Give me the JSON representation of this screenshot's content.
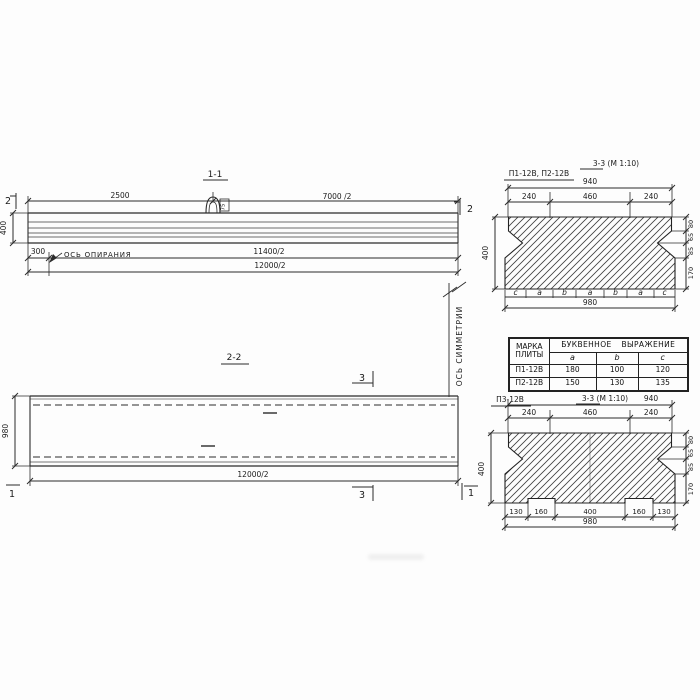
{
  "elevation": {
    "title": "1-1",
    "dim_2500": "2500",
    "dim_7000_2": "7000 /2",
    "dim_400": "400",
    "dim_300": "300",
    "support_axis": "ОСЬ ОПИРАНИЯ",
    "dim_11400_2": "11400/2",
    "dim_12000_2": "12000/2",
    "cut_mark_2": "2",
    "loop_mark": "75"
  },
  "symmetry_axis": "ОСЬ СИММЕТРИИ",
  "plan": {
    "title": "2-2",
    "dim_980": "980",
    "dim_12000_2": "12000/2",
    "cut_mark_3": "3",
    "cut_mark_1": "1"
  },
  "section_top": {
    "marks": "П1-12В, П2-12В",
    "title": "3-3 (М 1:10)",
    "dim_940": "940",
    "dim_240": "240",
    "dim_460": "460",
    "dim_400": "400",
    "dim_80": "80",
    "dim_65": "65",
    "dim_85": "85",
    "dim_170": "170",
    "letters": [
      "c",
      "a",
      "b",
      "a",
      "b",
      "a",
      "c"
    ],
    "dim_980": "980"
  },
  "legend_table": {
    "col_mark": "МАРКА ПЛИТЫ",
    "col_expr": "БУКВЕННОЕ ВЫРАЖЕНИЕ",
    "cols": [
      "a",
      "b",
      "c"
    ],
    "rows": [
      {
        "mark": "П1-12В",
        "a": "180",
        "b": "100",
        "c": "120"
      },
      {
        "mark": "П2-12В",
        "a": "150",
        "b": "130",
        "c": "135"
      }
    ]
  },
  "section_bottom": {
    "mark": "П3-12В",
    "title": "3-3 (М 1:10)",
    "dim_940": "940",
    "dim_240": "240",
    "dim_460": "460",
    "dim_400": "400",
    "dim_80": "80",
    "dim_65": "65",
    "dim_85": "85",
    "dim_170": "170",
    "dims_bottom": [
      "130",
      "160",
      "400",
      "160",
      "130"
    ],
    "dim_980": "980"
  }
}
